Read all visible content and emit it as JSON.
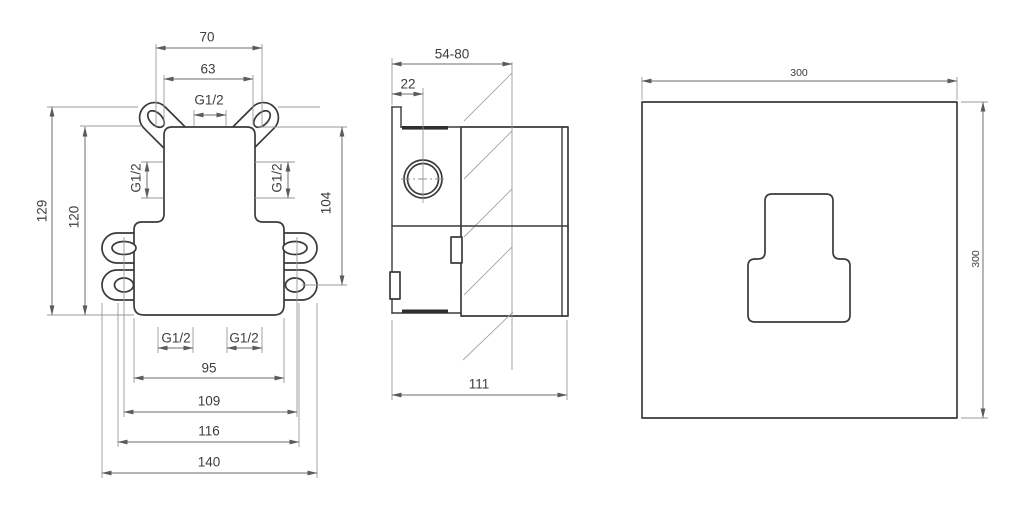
{
  "drawing": {
    "front": {
      "w70": "70",
      "w63": "63",
      "g12_top": "G1/2",
      "g12_side_l": "G1/2",
      "g12_side_r": "G1/2",
      "h129": "129",
      "h120": "120",
      "h104": "104",
      "g12_bot_l": "G1/2",
      "g12_bot_r": "G1/2",
      "w95": "95",
      "w109": "109",
      "w116": "116",
      "w140": "140"
    },
    "side": {
      "depth_range": "54-80",
      "offset22": "22",
      "depth111": "111"
    },
    "plate": {
      "w300": "300",
      "h300": "300"
    },
    "colors": {
      "background": "#ffffff",
      "object_line": "#3a3a3a",
      "dimension_line": "#6d6d6d",
      "text": "#3d3d3d"
    }
  }
}
